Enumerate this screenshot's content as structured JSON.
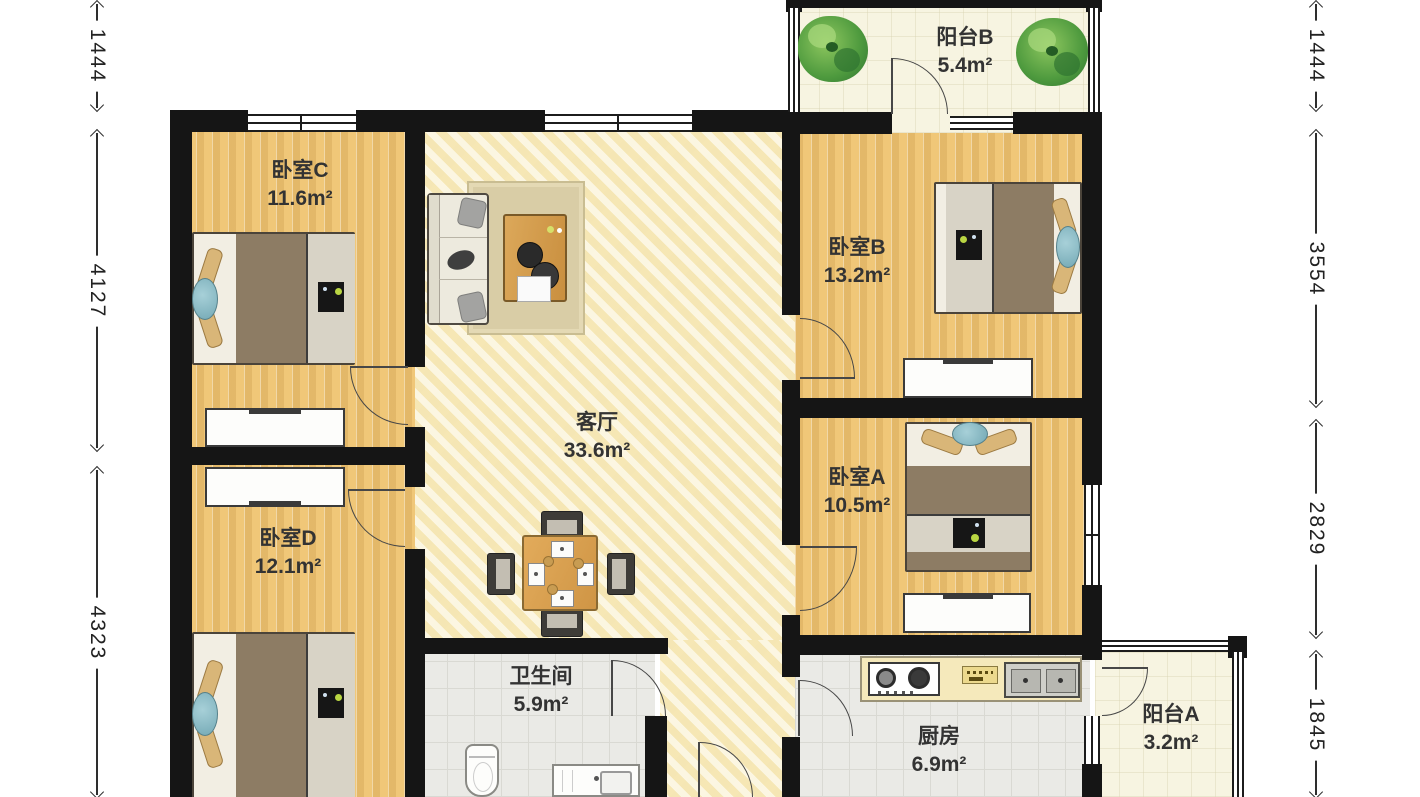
{
  "floorplan": {
    "rooms": [
      {
        "id": "balcony-b",
        "name": "阳台B",
        "area": "5.4m²"
      },
      {
        "id": "bedroom-c",
        "name": "卧室C",
        "area": "11.6m²"
      },
      {
        "id": "bedroom-b",
        "name": "卧室B",
        "area": "13.2m²"
      },
      {
        "id": "living-room",
        "name": "客厅",
        "area": "33.6m²"
      },
      {
        "id": "bedroom-a",
        "name": "卧室A",
        "area": "10.5m²"
      },
      {
        "id": "bedroom-d",
        "name": "卧室D",
        "area": "12.1m²"
      },
      {
        "id": "bathroom",
        "name": "卫生间",
        "area": "5.9m²"
      },
      {
        "id": "kitchen",
        "name": "厨房",
        "area": "6.9m²"
      },
      {
        "id": "balcony-a",
        "name": "阳台A",
        "area": "3.2m²"
      }
    ],
    "dimensions": {
      "left": [
        "1444",
        "4127",
        "4323"
      ],
      "right": [
        "1444",
        "3554",
        "2829",
        "1845"
      ]
    },
    "colors": {
      "wall": "#151515",
      "wood_floor": "#efc677",
      "marble_floor": "#f7ecc3",
      "tile_floor": "#eaeae6",
      "balcony_floor": "#f7f4e1",
      "plant_green": "#4e9a3e",
      "accent_teal": "#74a9b5",
      "bed_blanket": "#8d7c64"
    }
  }
}
